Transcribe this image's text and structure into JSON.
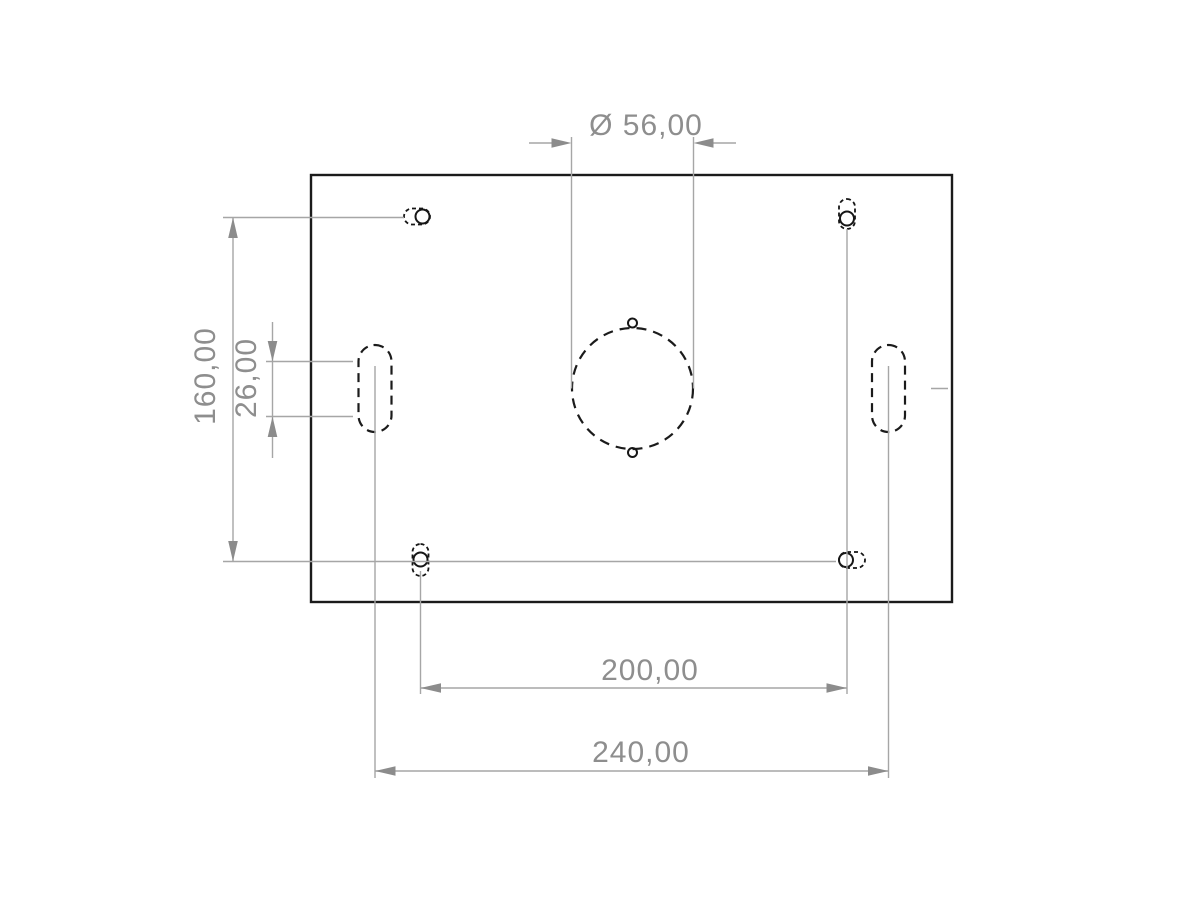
{
  "drawing": {
    "kind": "engineering-drawing",
    "part": "rectangular mounting plate, top view",
    "dimensions": {
      "diameter": "Ø 56,00",
      "vertical_outer": "160,00",
      "slot_length": "26,00",
      "horizontal_inner": "200,00",
      "horizontal_outer": "240,00"
    },
    "colors": {
      "background": "#ffffff",
      "part_outline": "#1b1b1b",
      "dimension_lines": "#a6a6a6",
      "dimension_arrows": "#8c8c8c",
      "dimension_text": "#8e8e8e"
    }
  }
}
